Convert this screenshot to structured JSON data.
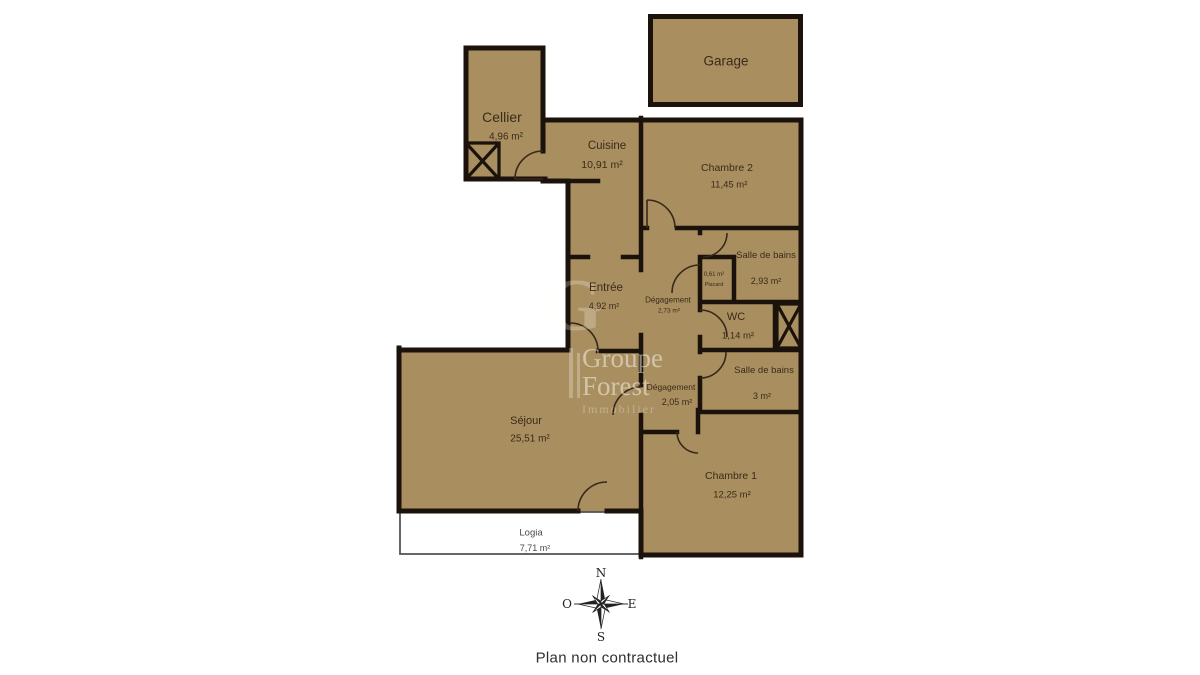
{
  "rooms": {
    "garage": {
      "name": "Garage",
      "area": ""
    },
    "cellier": {
      "name": "Cellier",
      "area": "4,96 m²"
    },
    "cuisine": {
      "name": "Cuisine",
      "area": "10,91 m²"
    },
    "chambre2": {
      "name": "Chambre 2",
      "area": "11,45 m²"
    },
    "sdb1": {
      "name": "Salle de bains",
      "area": "2,93 m²"
    },
    "placard": {
      "name": "Placard",
      "area": "0,61 m²"
    },
    "degagement1": {
      "name": "Dégagement",
      "area": "2,73 m²"
    },
    "entree": {
      "name": "Entrée",
      "area": "4,92 m²"
    },
    "wc": {
      "name": "WC",
      "area": "1,14 m²"
    },
    "sdb2": {
      "name": "Salle de bains",
      "area": "3 m²"
    },
    "degagement2": {
      "name": "Dégagement",
      "area": "2,05 m²"
    },
    "sejour": {
      "name": "Séjour",
      "area": "25,51 m²"
    },
    "chambre1": {
      "name": "Chambre 1",
      "area": "12,25 m²"
    },
    "logia": {
      "name": "Logia",
      "area": "7,71 m²"
    }
  },
  "compass": {
    "north": "N",
    "south": "S",
    "east": "E",
    "west": "O"
  },
  "watermark": {
    "monogram": "G",
    "brand_line1": "Groupe",
    "brand_line2": "Forest",
    "brand_line3": "Immobilier"
  },
  "footer": {
    "disclaimer": "Plan non contractuel"
  },
  "colors": {
    "room_fill": "#a98e60",
    "wall": "#1a120b",
    "label_text": "#3a2b18",
    "logia_fill": "#ffffff"
  }
}
